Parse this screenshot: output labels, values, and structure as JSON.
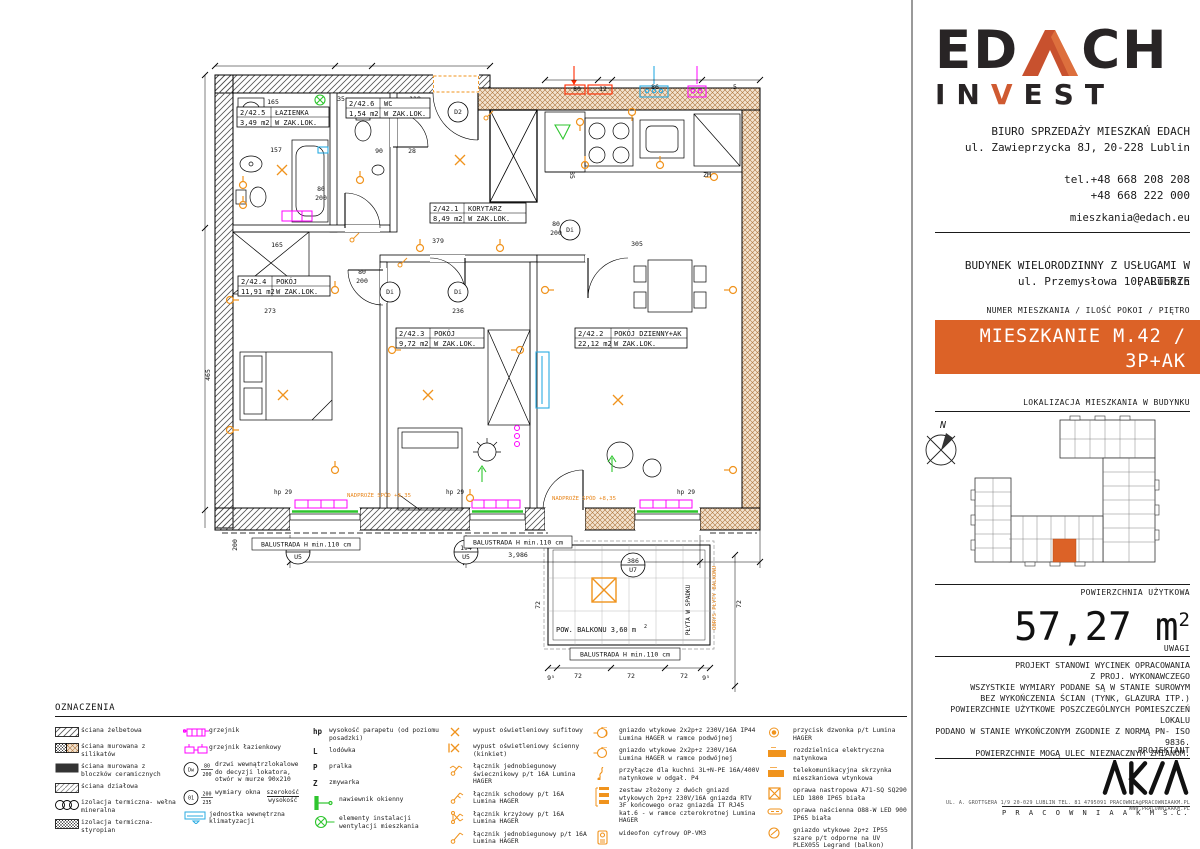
{
  "colors": {
    "accent_orange": "#DC6227",
    "electrical_orange": "#F0931D",
    "magenta": "#FF00FF",
    "green": "#2EC52E",
    "cyan": "#29ABE2",
    "red": "#FF2A00",
    "logo_dark": "#282425",
    "logo_orange": "#C8512E"
  },
  "sidebar": {
    "logo": {
      "ed": "ED",
      "ch": "CH",
      "in": "IN",
      "v": "V",
      "est": "EST"
    },
    "office_line1": "BIURO SPRZEDAŻY MIESZKAŃ EDACH",
    "office_line2": "ul. Zawieprzycka 8J, 20-228 Lublin",
    "phone1": "tel.+48 668 208 208",
    "phone2": "+48 668 222 000",
    "email": "mieszkania@edach.eu",
    "building_line1": "BUDYNEK WIELORODZINNY Z USŁUGAMI W PARTERZE",
    "building_line2": "ul. Przemysłowa 10, Lublin",
    "unit_header": "NUMER MIESZKANIA / ILOŚĆ POKOI / PIĘTRO",
    "unit_line1": "MIESZKANIE M.42 / 3P+AK",
    "unit_line2": "PIĘTRO 2",
    "location_header": "LOKALIZACJA MIESZKANIA W BUDYNKU",
    "compass_n": "N",
    "area_header": "POWIERZCHNIA UŻYTKOWA",
    "area_value": "57,27 m",
    "area_sup": "2",
    "uwagi_header": "UWAGI",
    "uwagi_lines": [
      "PROJEKT STANOWI WYCINEK OPRACOWANIA",
      "Z PROJ. WYKONAWCZEGO",
      "WSZYSTKIE WYMIARY PODANE SĄ W STANIE SUROWYM",
      "BEZ WYKOŃCZENIA ŚCIAN (TYNK, GLAZURA ITP.)",
      "POWIERZCHNIE UŻYTKOWE POSZCZEGÓLNYCH POMIESZCZEŃ LOKALU",
      "PODANO W STANIE WYKOŃCZONYM ZGODNIE Z NORMĄ PN- ISO 9836.",
      "POWIERZCHNIE MOGĄ ULEC NIEZNACZNYM ZMIANOM."
    ],
    "projektant_header": "PROJEKTANT",
    "akm_name": "P R A C O W N I A   A K M   S.C.",
    "akm_address": "UL. A. GROTTGERA 1/9   20-029 LUBLIN   TEL. 81 4795091   PRACOWNIA@PRACOWNIAAKM.PL   WWW.PRACOWNIAAKM.PL"
  },
  "plan": {
    "rooms": [
      {
        "id": "2/42.5",
        "name": "ŁAZIENKA",
        "area": "3,49 m2",
        "note": "W ZAK.LOK."
      },
      {
        "id": "2/42.6",
        "name": "WC",
        "area": "1,54 m2",
        "note": "W ZAK.LOK."
      },
      {
        "id": "2/42.1",
        "name": "KORYTARZ",
        "area": "8,49 m2",
        "note": "W ZAK.LOK."
      },
      {
        "id": "2/42.4",
        "name": "POKÓJ",
        "area": "11,91 m2",
        "note": "W ZAK.LOK."
      },
      {
        "id": "2/42.3",
        "name": "POKÓJ",
        "area": "9,72 m2",
        "note": "W ZAK.LOK."
      },
      {
        "id": "2/42.2",
        "name": "POKÓJ DZIENNY+AK",
        "area": "22,12 m2",
        "note": "W ZAK.LOK."
      }
    ],
    "door_tags": [
      "Di",
      "Di",
      "Di",
      "D2"
    ],
    "texts": {
      "balustrada": "BALUSTRADA H min.110 cm",
      "balkon": "POW. BALKONU  3,60 m",
      "sup2": "2",
      "nadproze": "NADPROŻE SPÓD +8,35",
      "plyta": "PŁYTA W SPADKU",
      "obrys": "OBRYS PŁYTY BALKONU",
      "hp": "hp 29",
      "zm": "ZM",
      "u5a": "194",
      "u5b": "U5",
      "u7a": "386",
      "u7b": "U7"
    },
    "dims": [
      "165",
      "35",
      "118",
      "80",
      "12",
      "86",
      "5",
      "157",
      "165",
      "273",
      "379",
      "236",
      "305",
      "85",
      "465",
      "80",
      "200",
      "80",
      "200",
      "80",
      "200",
      "90",
      "28",
      "3,986",
      "72",
      "72",
      "72",
      "9⁵",
      "9⁵",
      "72",
      "72",
      "200"
    ]
  },
  "legend": {
    "header": "OZNACZENIA",
    "col1": [
      {
        "label": "ściana żelbetowa"
      },
      {
        "label": "ściana murowana z silikatów"
      },
      {
        "label": "ściana murowana z bloczków ceramicznych"
      },
      {
        "label": "ściana działowa"
      },
      {
        "label": "izolacja termiczna- wełna mineralna"
      },
      {
        "label": "izolacja termiczna- styropian"
      }
    ],
    "col2": [
      {
        "label": "grzejnik"
      },
      {
        "label": "grzejnik łazienkowy"
      },
      {
        "label": "drzwi wewnątrzlokalowe do decyzji lokatora, otwór w murze 90x210"
      },
      {
        "label": "wymiary okna"
      },
      {
        "label": "jednostka wewnętrzna klimatyzacji"
      }
    ],
    "dw": {
      "top": "Dw",
      "num": "80",
      "den": "200"
    },
    "win": {
      "top": "01",
      "num": "200",
      "den": "235",
      "frac_top": "szerokość",
      "frac_bottom": "wysokość"
    },
    "col3": [
      {
        "key": "hp",
        "label": "wysokość parapetu (od poziomu posadzki)"
      },
      {
        "key": "L",
        "label": "lodówka"
      },
      {
        "key": "P",
        "label": "pralka"
      },
      {
        "key": "Z",
        "label": "zmywarka"
      },
      {
        "key": "",
        "label": "nawiewnik okienny"
      },
      {
        "key": "",
        "label": "elementy instalacji wentylacji mieszkania"
      }
    ],
    "col4": [
      {
        "label": "wypust oświetleniowy sufitowy"
      },
      {
        "label": "wypust oświetleniowy ścienny (kinkiet)"
      },
      {
        "label": "łącznik jednobiegunowy świecznikowy  p/t 16A Lumina HAGER"
      },
      {
        "label": "łącznik schodowy  p/t 16A Lumina HAGER"
      },
      {
        "label": "łącznik krzyżowy  p/t 16A Lumina HAGER"
      },
      {
        "label": "łącznik jednobiegunowy p/t 16A Lumina HAGER"
      }
    ],
    "col5": [
      {
        "label": "gniazdo wtykowe 2x2p+z 230V/16A IP44 Lumina HAGER w ramce podwójnej"
      },
      {
        "label": "gniazdo wtykowe 2x2p+z 230V/16A Lumina HAGER w ramce podwójnej"
      },
      {
        "label": "przyłącze dla kuchni 3L+N-PE 16A/400V natynkowe w odgał. P4"
      },
      {
        "label": "zestaw złożony z dwóch gniazd wtykowych 2p+z 230V/16A gniazda RTV 3F końcowego oraz gniazda IT RJ45 kat.6 - w ramce czterokrotnej Lumina HAGER"
      },
      {
        "label": "wideofon cyfrowy OP-VM3"
      }
    ],
    "col6": [
      {
        "label": "przycisk dzwonka p/t Lumina HAGER"
      },
      {
        "label": "rozdzielnica elektryczna natynkowa"
      },
      {
        "label": "telekomunikacyjna skrzynka mieszkaniowa wtynkowa"
      },
      {
        "label": "oprawa nastropowa A71-SQ SQ290 LED 1800 IP65 biała"
      },
      {
        "label": "oprawa naścienna O88-W LED 900 IP65 biała"
      },
      {
        "label": "gniazdo wtykowe 2p+z IP55 szare p/t odporne na UV PLEX055 Legrand (balkon)"
      }
    ]
  }
}
